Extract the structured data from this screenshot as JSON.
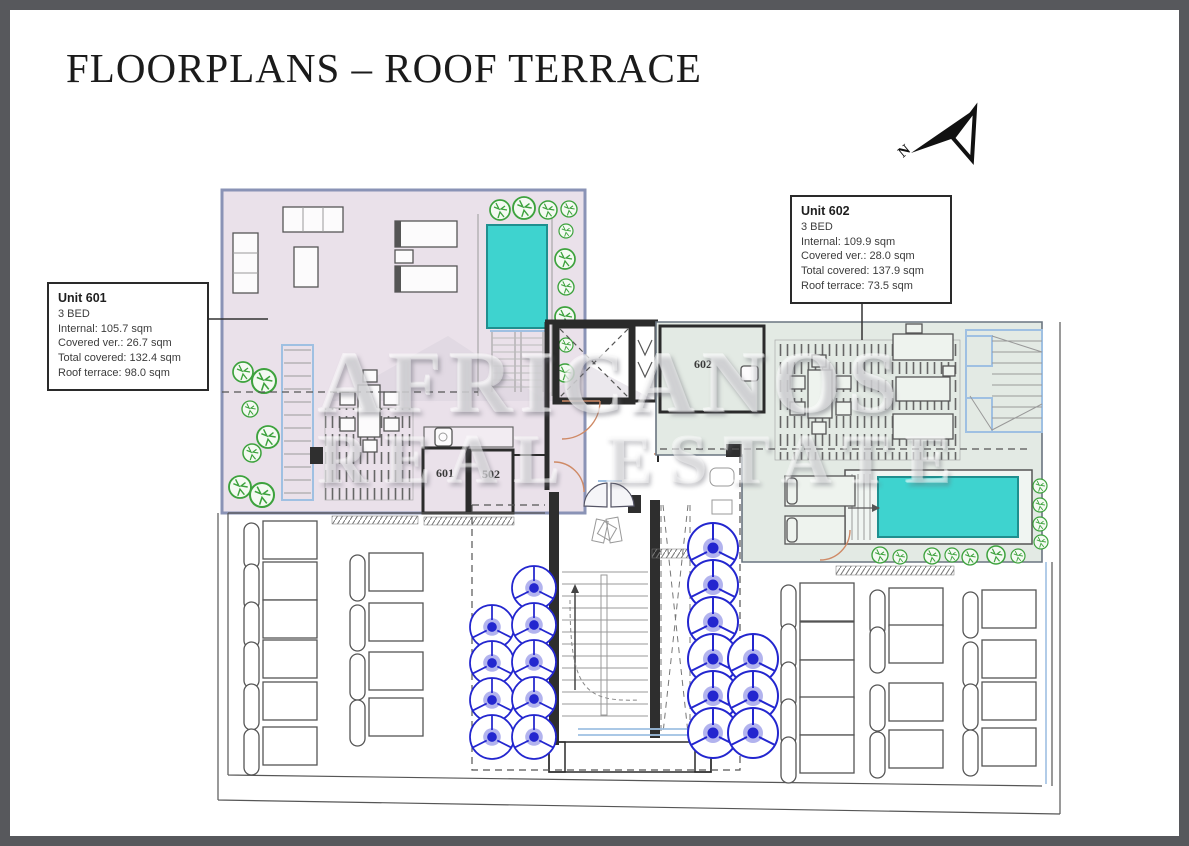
{
  "page": {
    "title": "FLOORPLANS – ROOF TERRACE"
  },
  "compass": {
    "label": "N"
  },
  "watermark": {
    "line1": "AFRICANOS",
    "line2": "REAL ESTATE"
  },
  "unit_601": {
    "name": "Unit 601",
    "beds": "3 BED",
    "internal": "Internal: 105.7 sqm",
    "covered_ver": "Covered ver.: 26.7 sqm",
    "total_covered": "Total covered: 132.4 sqm",
    "roof_terrace": "Roof terrace: 98.0 sqm"
  },
  "unit_602": {
    "name": "Unit 602",
    "beds": "3 BED",
    "internal": "Internal: 109.9 sqm",
    "covered_ver": "Covered ver.: 28.0 sqm",
    "total_covered": "Total covered: 137.9 sqm",
    "roof_terrace": "Roof terrace: 73.5 sqm"
  },
  "room_labels": {
    "room_601": "601",
    "room_502": "502",
    "room_602": "602"
  },
  "colors": {
    "frame": "#57585c",
    "pool": "#3ed3cf",
    "pool_edge": "#1f8f8f",
    "umbrella": "#2326cf",
    "plant": "#3da23d",
    "unit601_fill": "#eae1ea",
    "unit601_edge": "#8a93b6",
    "unit602_fill": "#e3eae4",
    "wall_dark": "#2b2b2b",
    "door": "#cf8a66",
    "stair_blue": "#9fc0e2"
  }
}
